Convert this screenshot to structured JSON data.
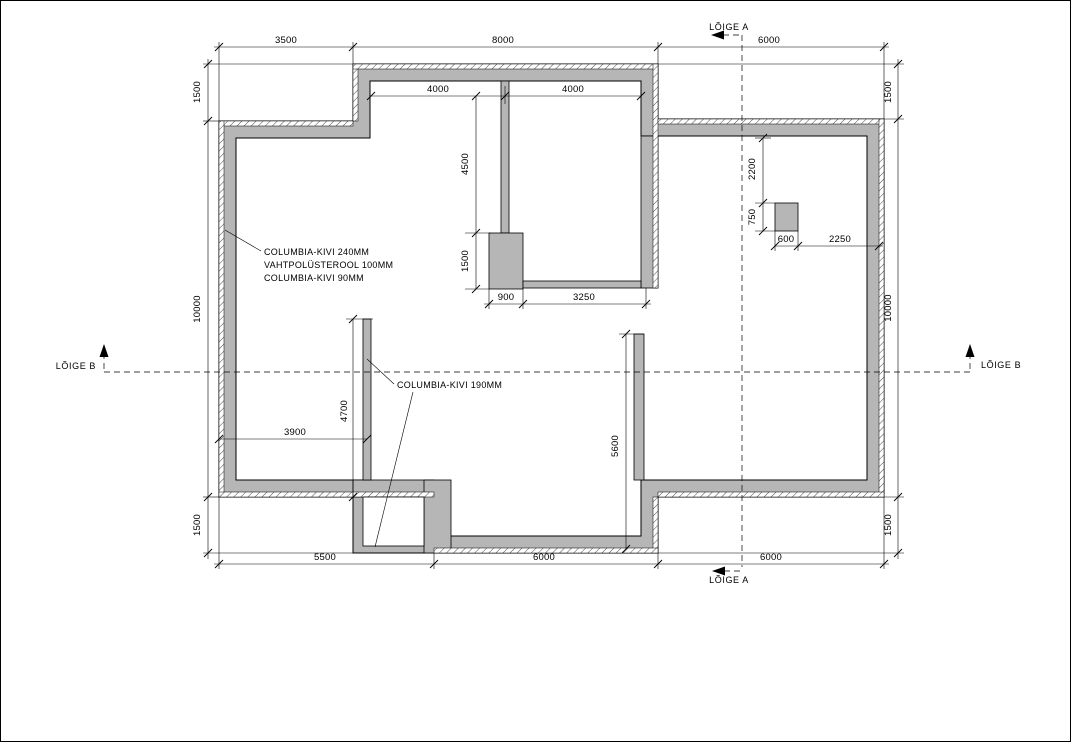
{
  "page": {
    "background": "#ffffff",
    "frame_color": "#000000"
  },
  "drawing": {
    "wall_fill": "#b6b6b6",
    "line_color": "#000000",
    "section_labels": {
      "a_top": "LÕIGE A",
      "a_bottom": "LÕIGE A",
      "b_left": "LÕIGE B",
      "b_right": "LÕIGE B"
    },
    "wall_specs": {
      "exterior_line1": "COLUMBIA-KIVI 240MM",
      "exterior_line2": "VAHTPOLÜSTEROOL 100MM",
      "exterior_line3": "COLUMBIA-KIVI 90MM",
      "interior": "COLUMBIA-KIVI 190MM"
    },
    "dimensions": {
      "top_left": "3500",
      "top_middle": "8000",
      "top_right": "6000",
      "left_upper": "1500",
      "left_middle": "10000",
      "left_lower": "1500",
      "right_upper": "1500",
      "right_middle": "10000",
      "right_lower": "1500",
      "bottom_left": "5500",
      "bottom_middle": "6000",
      "bottom_right": "6000",
      "room_left_width": "4000",
      "room_right_width": "4000",
      "room_depth": "4500",
      "chimney_height": "1500",
      "chimney_width": "900",
      "chimney_to_wall": "3250",
      "pillar_offset": "2200",
      "pillar_height": "750",
      "pillar_width": "600",
      "pillar_to_wall": "2250",
      "hall_width": "3900",
      "partition_left_length": "4700",
      "partition_right_length": "5600"
    }
  }
}
